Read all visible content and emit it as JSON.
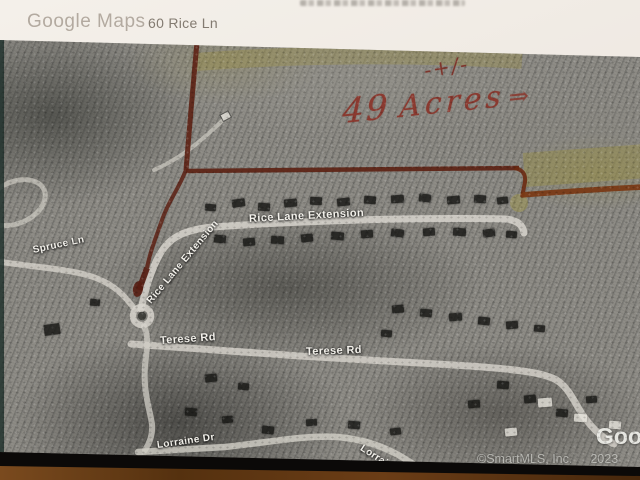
{
  "header": {
    "logo": "Google Maps",
    "address": "60 Rice Ln"
  },
  "annotations": {
    "plus_minus": "-+/-",
    "acreage_number": "49",
    "acreage_unit": "Acres",
    "arrow": "⇒",
    "marker_color": "#5d2114",
    "highlight_color": "#a09540"
  },
  "map": {
    "street_labels": [
      {
        "text": "Spruce Ln",
        "x": 33,
        "y": 245,
        "rot": -12,
        "size": 10
      },
      {
        "text": "Rice Lane Extension",
        "x": 149,
        "y": 297,
        "rot": -50,
        "size": 10
      },
      {
        "text": "Rice Lane Extension",
        "x": 249,
        "y": 213,
        "rot": -3,
        "size": 11
      },
      {
        "text": "Terese Rd",
        "x": 160,
        "y": 335,
        "rot": -4,
        "size": 11
      },
      {
        "text": "Terese Rd",
        "x": 306,
        "y": 346,
        "rot": -2,
        "size": 11
      },
      {
        "text": "Lorraine Dr",
        "x": 157,
        "y": 440,
        "rot": -8,
        "size": 10
      },
      {
        "text": "Lorraine Dr",
        "x": 361,
        "y": 442,
        "rot": 33,
        "size": 10
      }
    ]
  },
  "watermarks": {
    "google": "Goo",
    "copyright": "©SmartMLS, Inc.",
    "year": "2023"
  }
}
